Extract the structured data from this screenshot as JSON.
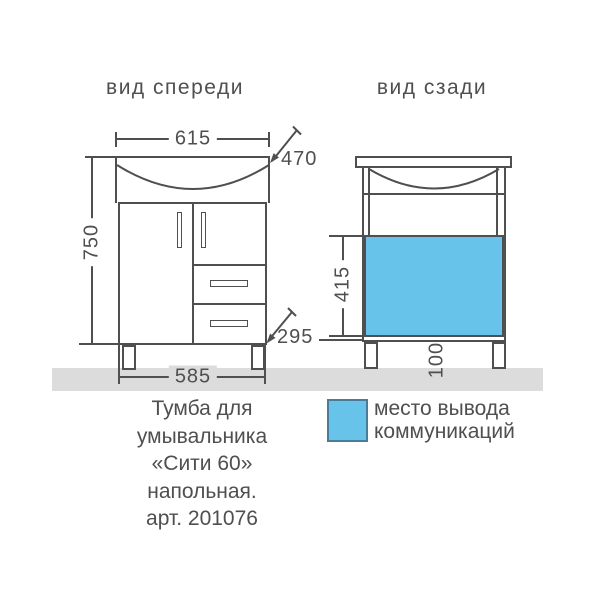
{
  "drawing": {
    "front": {
      "title": "вид спереди",
      "dims": {
        "top_width": "615",
        "basin_depth": "470",
        "height": "750",
        "body_width": "585",
        "plinth_depth": "295"
      }
    },
    "back": {
      "title": "вид сзади",
      "dims": {
        "comm_zone_height": "415",
        "leg_height": "100"
      }
    },
    "caption": {
      "lines": [
        "Тумба для",
        "умывальника",
        "«Сити 60»",
        "напольная.",
        "арт. 201076"
      ]
    },
    "legend": {
      "line1": "место вывода",
      "line2": "коммуникаций"
    }
  },
  "colors": {
    "line": "#4f4f4f",
    "text": "#4f4f4f",
    "blue_fill": "#68c3ea",
    "blue_border": "#4a7c98",
    "floor": "#dcdcdc",
    "background": "#ffffff"
  }
}
